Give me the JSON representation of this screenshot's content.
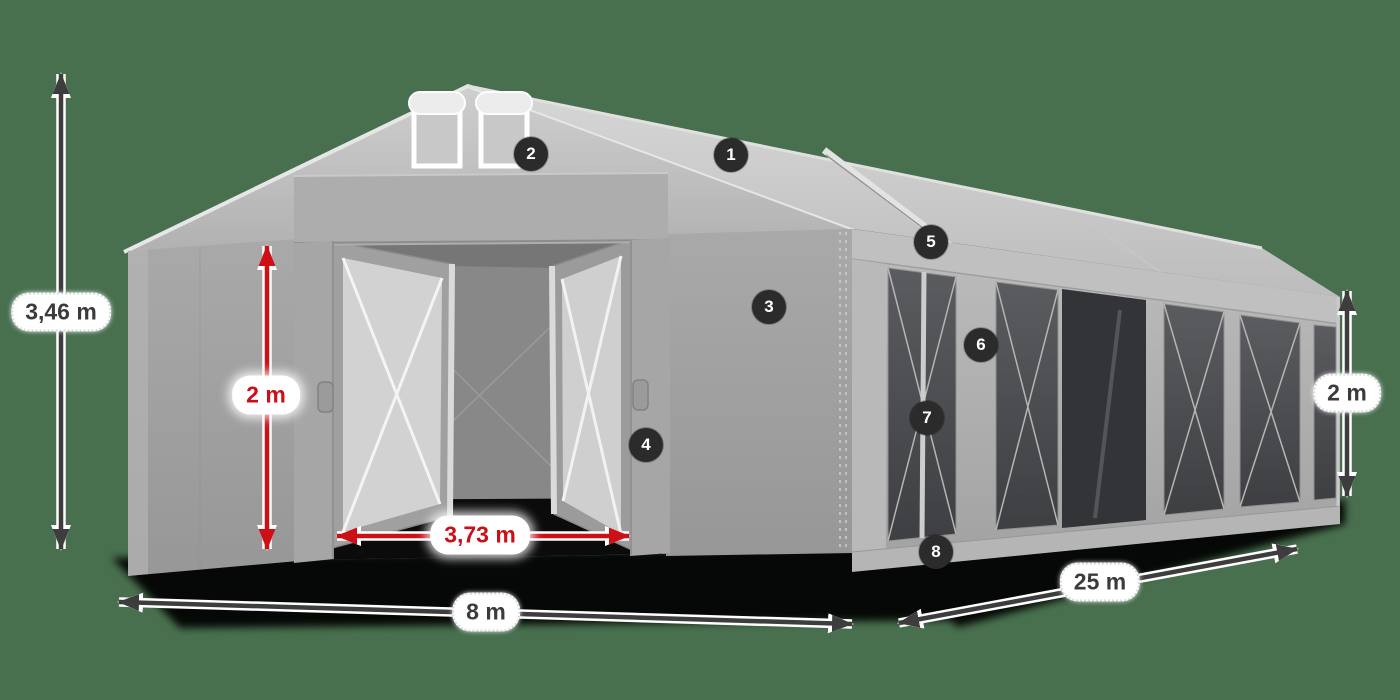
{
  "diagram": {
    "type": "tent-dimension-diagram",
    "subject": "gray marquee tent with open entrance, numbered part callouts and size arrows",
    "dimensions": {
      "total_height": "3,46 m",
      "entrance_height": "2 m",
      "entrance_width": "3,73 m",
      "width": "8 m",
      "length": "25 m",
      "side_height": "2 m"
    },
    "callouts": [
      "1",
      "2",
      "3",
      "4",
      "5",
      "6",
      "7",
      "8"
    ],
    "colors": {
      "background": "#48704e",
      "arrow_dark": "#3d3d3d",
      "arrow_red": "#cc1016",
      "label_background": "#ffffff",
      "label_text_dark": "#3b3b3b",
      "label_text_red": "#c90f18",
      "badge_background": "#2b2b2b",
      "badge_text": "#ffffff",
      "tent_fabric_light": "#cdcdcd",
      "tent_fabric_mid": "#a6a6a6",
      "window_dark": "#46484c",
      "ground_shadow": "#000000"
    }
  }
}
